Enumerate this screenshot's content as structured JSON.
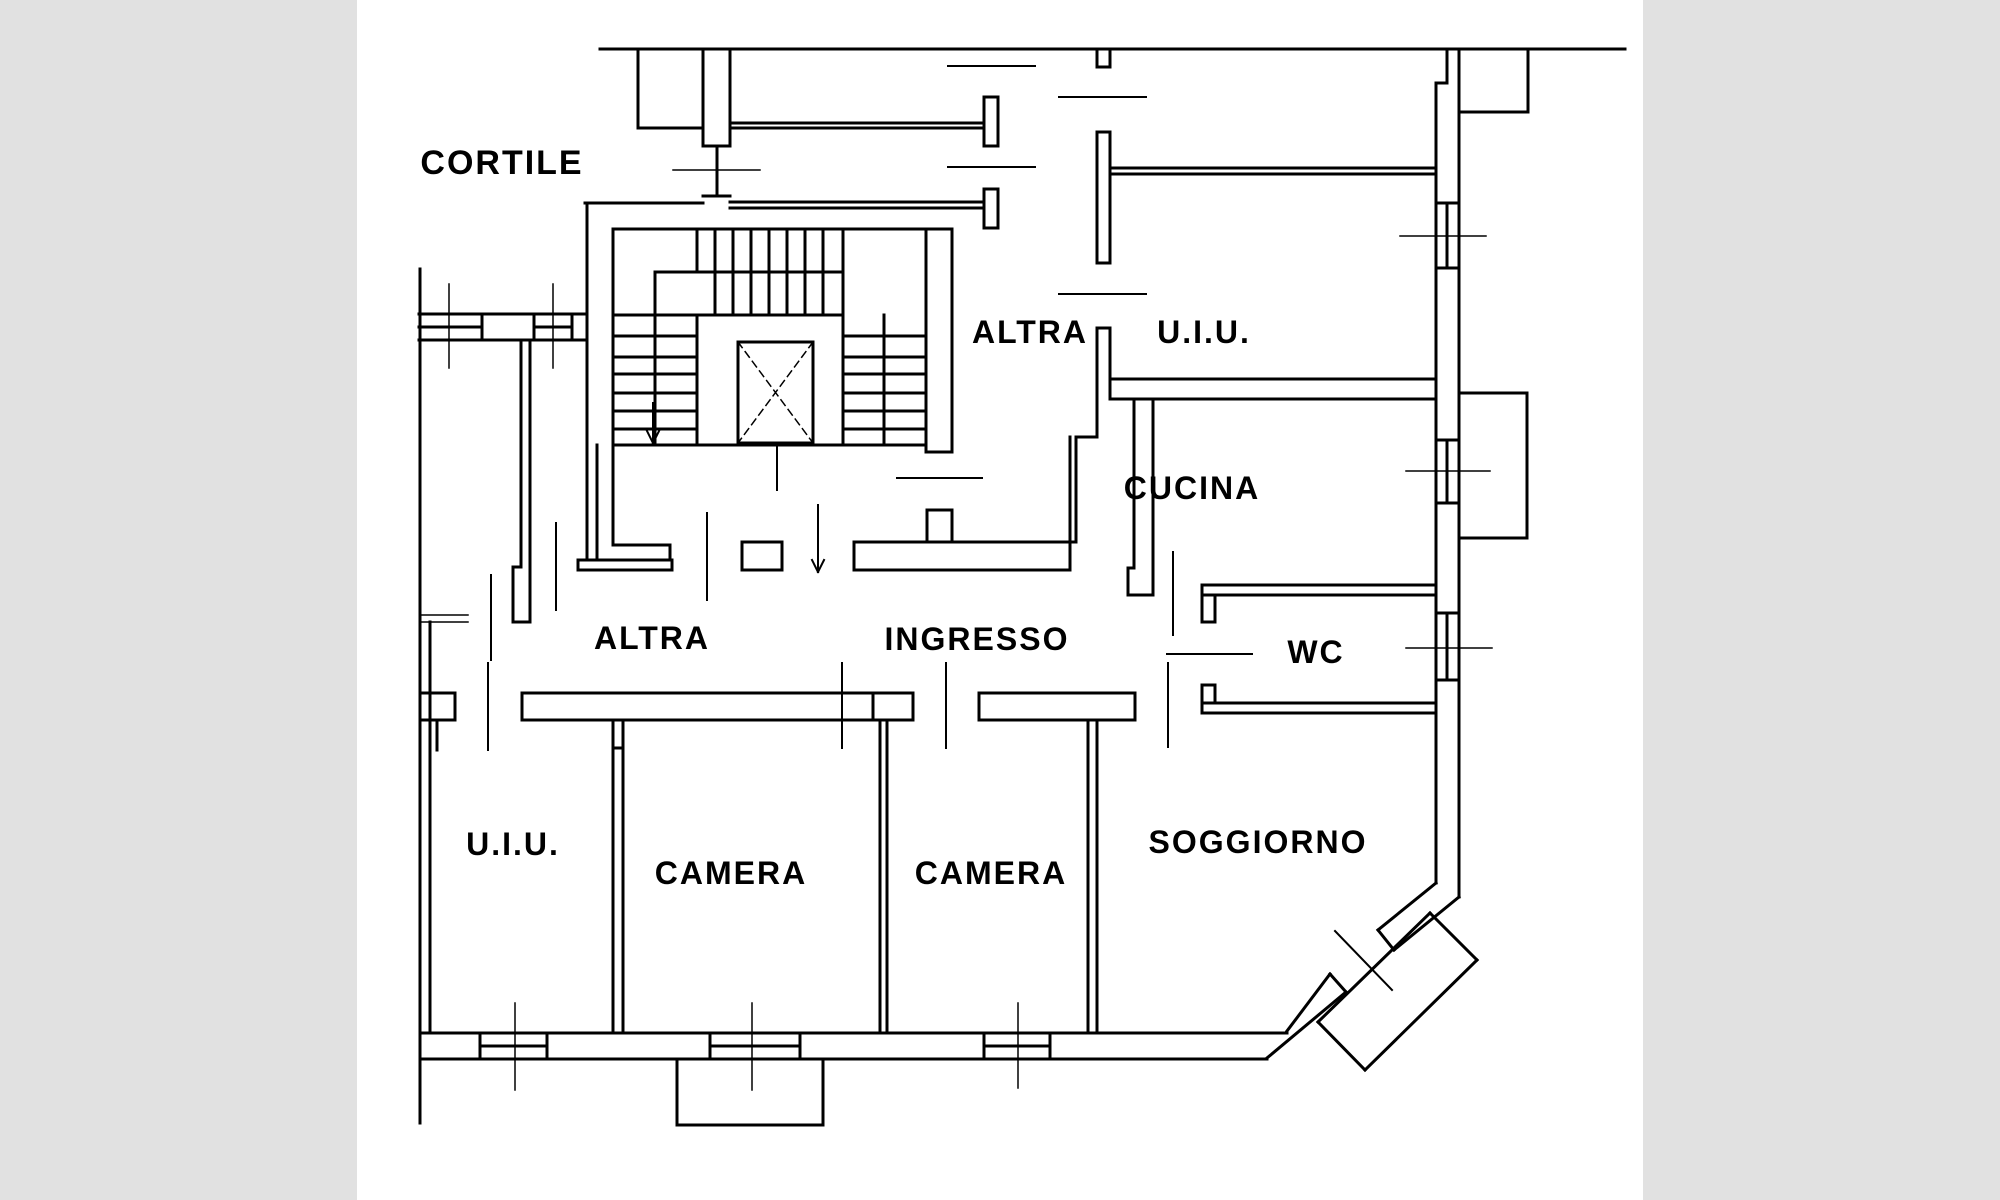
{
  "canvas": {
    "width": 2000,
    "height": 1200,
    "letterbox_color": "#e1e1e1",
    "paper_color": "#ffffff",
    "paper_x": 357,
    "paper_width": 1286,
    "line_color": "#000000"
  },
  "labels": [
    {
      "id": "cortile",
      "text": "CORTILE",
      "x": 502,
      "y": 174,
      "size": 34
    },
    {
      "id": "altra-top",
      "text": "ALTRA",
      "x": 1030,
      "y": 343,
      "size": 32
    },
    {
      "id": "uiu-top",
      "text": "U.I.U.",
      "x": 1204,
      "y": 343,
      "size": 32
    },
    {
      "id": "cucina",
      "text": "CUCINA",
      "x": 1192,
      "y": 499,
      "size": 32
    },
    {
      "id": "wc",
      "text": "WC",
      "x": 1316,
      "y": 663,
      "size": 32
    },
    {
      "id": "altra-mid",
      "text": "ALTRA",
      "x": 652,
      "y": 649,
      "size": 32
    },
    {
      "id": "ingresso",
      "text": "INGRESSO",
      "x": 977,
      "y": 650,
      "size": 32
    },
    {
      "id": "uiu-left",
      "text": "U.I.U.",
      "x": 513,
      "y": 855,
      "size": 32
    },
    {
      "id": "camera-left",
      "text": "CAMERA",
      "x": 731,
      "y": 884,
      "size": 32
    },
    {
      "id": "camera-right",
      "text": "CAMERA",
      "x": 991,
      "y": 884,
      "size": 32
    },
    {
      "id": "soggiorno",
      "text": "SOGGIORNO",
      "x": 1258,
      "y": 853,
      "size": 32
    }
  ],
  "chart_data": {
    "type": "floorplan",
    "rooms": [
      "CORTILE",
      "ALTRA U.I.U.",
      "CUCINA",
      "WC",
      "ALTRA",
      "INGRESSO",
      "U.I.U.",
      "CAMERA",
      "CAMERA",
      "SOGGIORNO"
    ]
  },
  "geometry": {
    "walls": [
      [
        600,
        49,
        1625,
        49
      ],
      [
        638,
        49,
        638,
        128
      ],
      [
        638,
        128,
        703,
        128
      ],
      [
        703,
        49,
        703,
        146
      ],
      [
        730,
        49,
        730,
        146
      ],
      [
        703,
        146,
        730,
        146
      ],
      [
        703,
        196,
        730,
        196
      ],
      [
        717,
        146,
        717,
        196
      ],
      [
        585,
        203,
        703,
        203
      ],
      [
        730,
        202,
        984,
        202
      ],
      [
        730,
        208,
        984,
        208
      ],
      [
        730,
        123,
        984,
        123
      ],
      [
        730,
        128,
        984,
        128
      ],
      [
        984,
        97,
        998,
        97
      ],
      [
        984,
        146,
        998,
        146
      ],
      [
        984,
        97,
        984,
        146
      ],
      [
        998,
        97,
        998,
        146
      ],
      [
        984,
        189,
        998,
        189
      ],
      [
        984,
        228,
        998,
        228
      ],
      [
        984,
        189,
        984,
        228
      ],
      [
        998,
        189,
        998,
        228
      ],
      [
        1097,
        49,
        1097,
        67
      ],
      [
        1110,
        49,
        1110,
        67
      ],
      [
        1097,
        67,
        1110,
        67
      ],
      [
        1097,
        132,
        1097,
        263
      ],
      [
        1110,
        132,
        1110,
        263
      ],
      [
        1097,
        132,
        1110,
        132
      ],
      [
        1097,
        263,
        1110,
        263
      ],
      [
        1110,
        168,
        1436,
        168
      ],
      [
        1110,
        174,
        1436,
        174
      ],
      [
        1447,
        49,
        1447,
        83
      ],
      [
        1436,
        83,
        1447,
        83
      ],
      [
        1436,
        83,
        1436,
        883
      ],
      [
        1459,
        49,
        1459,
        897
      ],
      [
        1436,
        203,
        1459,
        203
      ],
      [
        1436,
        268,
        1459,
        268
      ],
      [
        1447,
        203,
        1447,
        268
      ],
      [
        1528,
        49,
        1528,
        112
      ],
      [
        1459,
        112,
        1528,
        112
      ],
      [
        587,
        203,
        587,
        314
      ],
      [
        419,
        314,
        587,
        314
      ],
      [
        419,
        340,
        587,
        340
      ],
      [
        419,
        327,
        482,
        327
      ],
      [
        534,
        327,
        572,
        327
      ],
      [
        482,
        314,
        482,
        340
      ],
      [
        534,
        314,
        534,
        340
      ],
      [
        572,
        314,
        572,
        340
      ],
      [
        587,
        314,
        587,
        340
      ],
      [
        420,
        269,
        420,
        1123
      ],
      [
        430,
        622,
        430,
        1030
      ],
      [
        420,
        693,
        455,
        693
      ],
      [
        420,
        720,
        455,
        720
      ],
      [
        455,
        693,
        455,
        720
      ],
      [
        437,
        720,
        437,
        750
      ],
      [
        521,
        340,
        521,
        567
      ],
      [
        530,
        340,
        530,
        567
      ],
      [
        513,
        567,
        521,
        567
      ],
      [
        513,
        567,
        513,
        622
      ],
      [
        530,
        567,
        530,
        622
      ],
      [
        513,
        622,
        530,
        622
      ],
      [
        587,
        340,
        587,
        560
      ],
      [
        597,
        445,
        597,
        560
      ],
      [
        578,
        560,
        672,
        560
      ],
      [
        578,
        570,
        672,
        570
      ],
      [
        578,
        560,
        578,
        570
      ],
      [
        672,
        560,
        672,
        570
      ],
      [
        613,
        229,
        952,
        229
      ],
      [
        613,
        229,
        613,
        545
      ],
      [
        613,
        545,
        670,
        545
      ],
      [
        670,
        545,
        670,
        560
      ],
      [
        926,
        229,
        926,
        452
      ],
      [
        952,
        229,
        952,
        452
      ],
      [
        926,
        452,
        952,
        452
      ],
      [
        613,
        445,
        926,
        445
      ],
      [
        655,
        272,
        843,
        272
      ],
      [
        613,
        315,
        843,
        315
      ],
      [
        655,
        272,
        655,
        445
      ],
      [
        697,
        315,
        697,
        445
      ],
      [
        843,
        229,
        843,
        445
      ],
      [
        884,
        315,
        884,
        445
      ],
      [
        697,
        229,
        697,
        272
      ],
      [
        715,
        229,
        715,
        272
      ],
      [
        733,
        229,
        733,
        272
      ],
      [
        751,
        229,
        751,
        272
      ],
      [
        769,
        229,
        769,
        272
      ],
      [
        787,
        229,
        787,
        272
      ],
      [
        805,
        229,
        805,
        272
      ],
      [
        823,
        229,
        823,
        272
      ],
      [
        715,
        272,
        715,
        315
      ],
      [
        733,
        272,
        733,
        315
      ],
      [
        751,
        272,
        751,
        315
      ],
      [
        769,
        272,
        769,
        315
      ],
      [
        787,
        272,
        787,
        315
      ],
      [
        805,
        272,
        805,
        315
      ],
      [
        823,
        272,
        823,
        315
      ],
      [
        613,
        336,
        697,
        336
      ],
      [
        613,
        357,
        697,
        357
      ],
      [
        613,
        374,
        697,
        374
      ],
      [
        613,
        393,
        697,
        393
      ],
      [
        613,
        411,
        697,
        411
      ],
      [
        613,
        429,
        697,
        429
      ],
      [
        843,
        336,
        926,
        336
      ],
      [
        843,
        357,
        926,
        357
      ],
      [
        843,
        374,
        926,
        374
      ],
      [
        843,
        393,
        926,
        393
      ],
      [
        843,
        411,
        926,
        411
      ],
      [
        843,
        429,
        926,
        429
      ],
      [
        738,
        342,
        813,
        342
      ],
      [
        738,
        443,
        813,
        443
      ],
      [
        738,
        342,
        738,
        443
      ],
      [
        813,
        342,
        813,
        443
      ],
      [
        927,
        510,
        952,
        510
      ],
      [
        927,
        510,
        927,
        542
      ],
      [
        952,
        510,
        952,
        542
      ],
      [
        742,
        542,
        782,
        542
      ],
      [
        742,
        570,
        782,
        570
      ],
      [
        782,
        542,
        782,
        570
      ],
      [
        742,
        542,
        742,
        570
      ],
      [
        854,
        542,
        1076,
        542
      ],
      [
        854,
        570,
        1070,
        570
      ],
      [
        854,
        542,
        854,
        570
      ],
      [
        1070,
        437,
        1070,
        570
      ],
      [
        1076,
        437,
        1076,
        542
      ],
      [
        1076,
        437,
        1097,
        437
      ],
      [
        1097,
        328,
        1097,
        437
      ],
      [
        1110,
        328,
        1110,
        399
      ],
      [
        1097,
        328,
        1110,
        328
      ],
      [
        1110,
        379,
        1436,
        379
      ],
      [
        1110,
        399,
        1436,
        399
      ],
      [
        1134,
        399,
        1134,
        568
      ],
      [
        1153,
        399,
        1153,
        595
      ],
      [
        1128,
        568,
        1134,
        568
      ],
      [
        1128,
        568,
        1128,
        595
      ],
      [
        1128,
        595,
        1153,
        595
      ],
      [
        1436,
        440,
        1459,
        440
      ],
      [
        1436,
        503,
        1459,
        503
      ],
      [
        1447,
        440,
        1447,
        503
      ],
      [
        1459,
        393,
        1527,
        393
      ],
      [
        1527,
        393,
        1527,
        538
      ],
      [
        1459,
        538,
        1527,
        538
      ],
      [
        1436,
        613,
        1459,
        613
      ],
      [
        1436,
        680,
        1459,
        680
      ],
      [
        1447,
        613,
        1447,
        680
      ],
      [
        1202,
        585,
        1436,
        585
      ],
      [
        1202,
        595,
        1436,
        595
      ],
      [
        1202,
        585,
        1202,
        622
      ],
      [
        1215,
        595,
        1215,
        622
      ],
      [
        1202,
        622,
        1215,
        622
      ],
      [
        1202,
        703,
        1436,
        703
      ],
      [
        1202,
        713,
        1436,
        713
      ],
      [
        1202,
        685,
        1202,
        713
      ],
      [
        1215,
        685,
        1215,
        703
      ],
      [
        1202,
        685,
        1215,
        685
      ],
      [
        522,
        693,
        873,
        693
      ],
      [
        522,
        720,
        873,
        720
      ],
      [
        522,
        693,
        522,
        720
      ],
      [
        873,
        693,
        913,
        693
      ],
      [
        873,
        720,
        913,
        720
      ],
      [
        873,
        693,
        873,
        720
      ],
      [
        913,
        693,
        913,
        720
      ],
      [
        979,
        693,
        1135,
        693
      ],
      [
        979,
        720,
        1135,
        720
      ],
      [
        979,
        693,
        979,
        720
      ],
      [
        1135,
        693,
        1135,
        720
      ],
      [
        613,
        720,
        613,
        1030
      ],
      [
        623,
        720,
        623,
        1030
      ],
      [
        613,
        748,
        623,
        748
      ],
      [
        880,
        720,
        880,
        1033
      ],
      [
        887,
        720,
        887,
        1033
      ],
      [
        1088,
        720,
        1088,
        1033
      ],
      [
        1097,
        720,
        1097,
        1033
      ],
      [
        420,
        1033,
        1287,
        1033
      ],
      [
        420,
        1059,
        1267,
        1059
      ],
      [
        480,
        1033,
        480,
        1059
      ],
      [
        547,
        1033,
        547,
        1059
      ],
      [
        710,
        1033,
        710,
        1059
      ],
      [
        800,
        1033,
        800,
        1059
      ],
      [
        984,
        1033,
        984,
        1059
      ],
      [
        1050,
        1033,
        1050,
        1059
      ],
      [
        480,
        1046,
        547,
        1046
      ],
      [
        710,
        1046,
        800,
        1046
      ],
      [
        984,
        1046,
        1050,
        1046
      ],
      [
        677,
        1059,
        677,
        1125
      ],
      [
        823,
        1059,
        823,
        1125
      ],
      [
        677,
        1125,
        823,
        1125
      ],
      [
        1436,
        883,
        1378,
        930
      ],
      [
        1378,
        930,
        1394,
        950
      ],
      [
        1459,
        897,
        1394,
        950
      ],
      [
        1330,
        974,
        1287,
        1031
      ],
      [
        1330,
        974,
        1346,
        992
      ],
      [
        1346,
        992,
        1267,
        1058
      ],
      [
        1430,
        913,
        1477,
        960
      ],
      [
        1477,
        960,
        1365,
        1070
      ],
      [
        1365,
        1070,
        1318,
        1022
      ],
      [
        1318,
        1022,
        1430,
        913
      ]
    ],
    "medium_lines": [
      [
        948,
        66,
        1035,
        66
      ],
      [
        1059,
        97,
        1146,
        97
      ],
      [
        948,
        167,
        1035,
        167
      ],
      [
        1059,
        294,
        1146,
        294
      ],
      [
        897,
        478,
        982,
        478
      ],
      [
        1167,
        654,
        1252,
        654
      ],
      [
        1173,
        552,
        1173,
        635
      ],
      [
        1168,
        663,
        1168,
        747
      ],
      [
        842,
        663,
        842,
        748
      ],
      [
        946,
        663,
        946,
        748
      ],
      [
        556,
        523,
        556,
        610
      ],
      [
        491,
        575,
        491,
        660
      ],
      [
        488,
        663,
        488,
        750
      ],
      [
        707,
        513,
        707,
        600
      ],
      [
        653,
        403,
        653,
        443
      ],
      [
        647,
        431,
        653,
        443
      ],
      [
        659,
        431,
        653,
        443
      ],
      [
        818,
        505,
        818,
        572
      ],
      [
        812,
        560,
        818,
        572
      ],
      [
        824,
        560,
        818,
        572
      ],
      [
        777,
        443,
        777,
        490
      ],
      [
        1335,
        931,
        1392,
        990
      ]
    ],
    "thin_lines": [
      [
        673,
        170,
        760,
        170
      ],
      [
        1400,
        236,
        1486,
        236
      ],
      [
        1406,
        471,
        1490,
        471
      ],
      [
        1406,
        648,
        1492,
        648
      ],
      [
        449,
        284,
        449,
        368
      ],
      [
        553,
        284,
        553,
        368
      ],
      [
        420,
        615,
        468,
        615
      ],
      [
        420,
        622,
        468,
        622
      ],
      [
        515,
        1003,
        515,
        1090
      ],
      [
        752,
        1003,
        752,
        1090
      ],
      [
        1018,
        1003,
        1018,
        1088
      ]
    ],
    "dashed_lines": [
      [
        738,
        342,
        813,
        443
      ],
      [
        813,
        342,
        738,
        443
      ]
    ]
  }
}
